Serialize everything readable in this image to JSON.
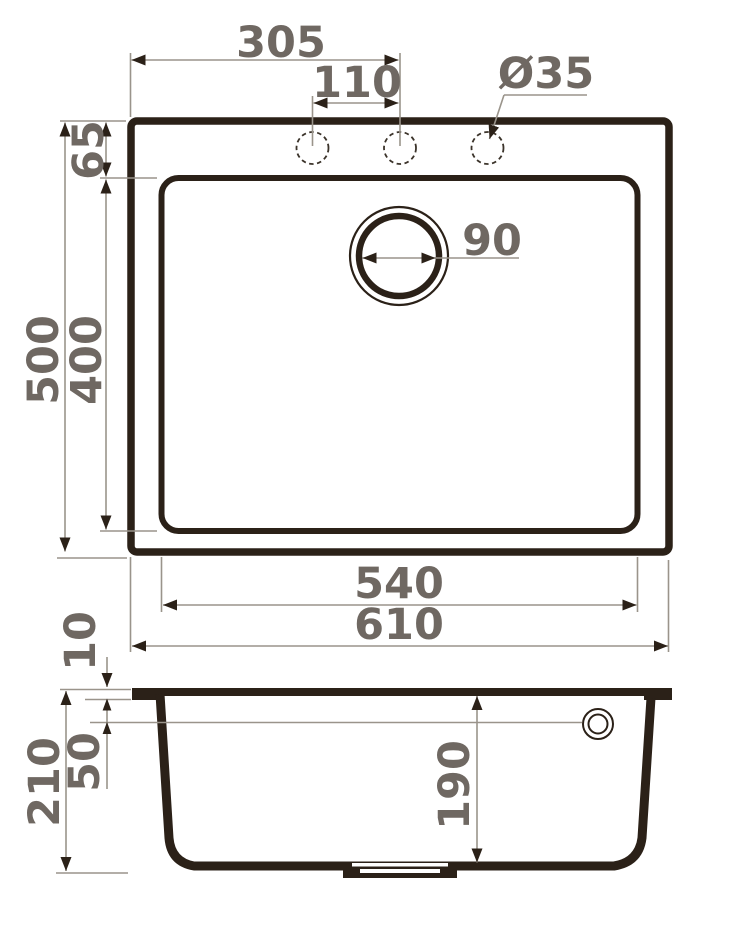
{
  "drawing": {
    "top_view": {
      "center_offset": "305",
      "hole_pitch": "110",
      "hole_diameter": "Ø35",
      "edge_to_bowl": "65",
      "overall_depth": "500",
      "bowl_depth": "400",
      "drain_diameter": "90",
      "bowl_width": "540",
      "overall_width": "610"
    },
    "section_view": {
      "rim_thickness": "10",
      "overall_height": "210",
      "ledge_height": "50",
      "bowl_inner_depth": "190"
    },
    "colors": {
      "outline_ink": "#2b2118",
      "dimension_line": "#9a948b",
      "dimension_text": "#6f6862",
      "background": "#ffffff"
    }
  }
}
